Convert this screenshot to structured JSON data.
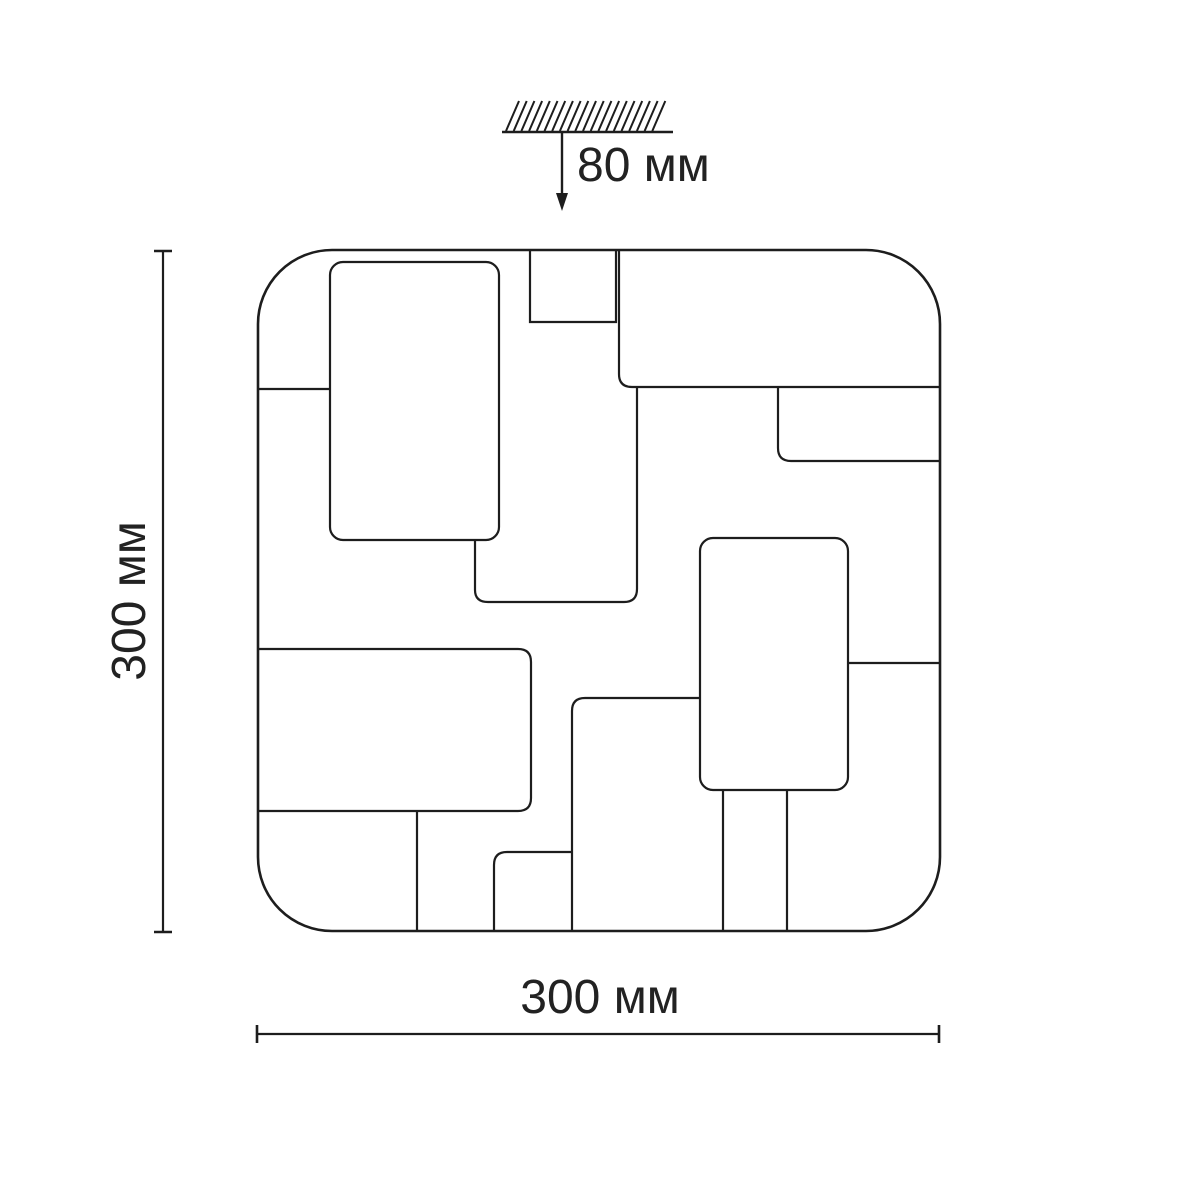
{
  "drawing": {
    "description": "Technical dimension drawing of a square ceiling light fixture with rounded corners, front view, decorated with an abstract pattern of rectangular panels; hatched ceiling mount symbol above",
    "view": "front",
    "labels": {
      "mount_height": "80 мм",
      "side_height": "300 мм",
      "bottom_width": "300 мм"
    },
    "dimensions": {
      "mount_height_mm": 80,
      "height_mm": 300,
      "width_mm": 300,
      "unit": "мм"
    },
    "colors": {
      "line": "#1d1d1d",
      "text": "#222222",
      "background": "#ffffff"
    }
  }
}
